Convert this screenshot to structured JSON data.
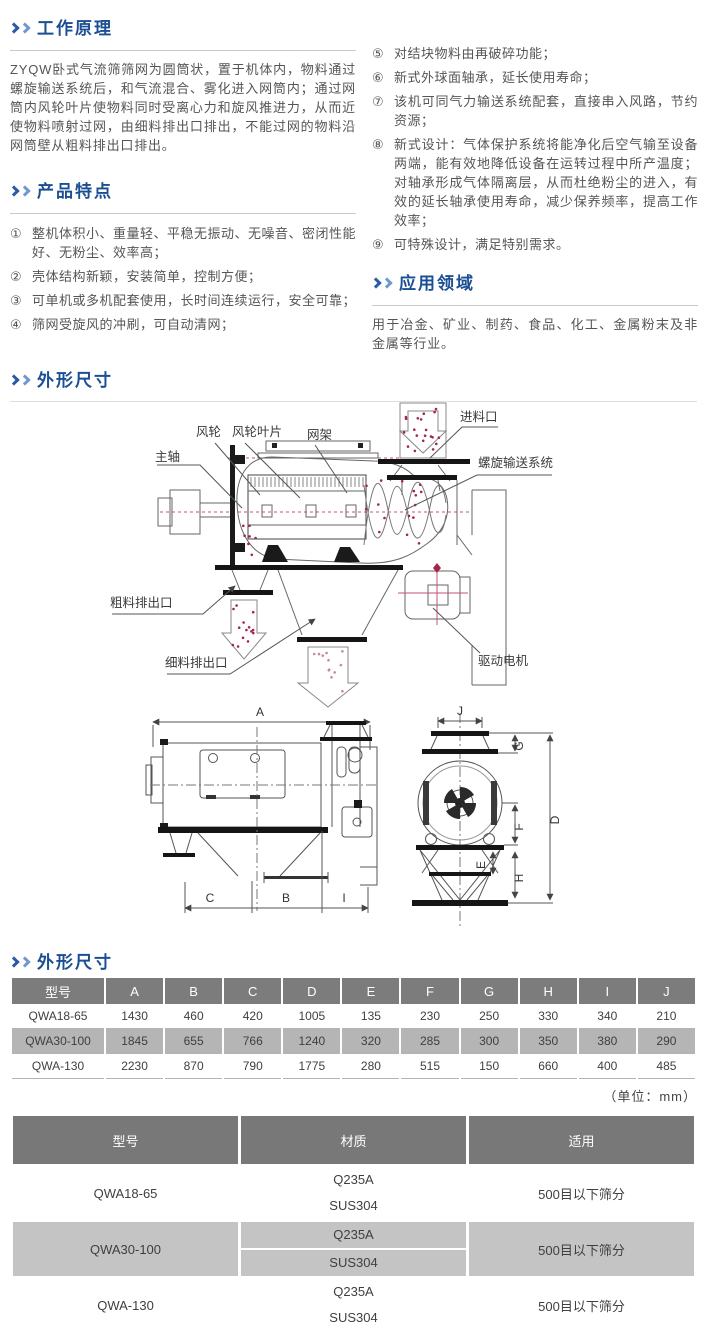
{
  "colors": {
    "accent_blue": "#1b4f93",
    "chevron_dark": "#2a5aa5",
    "chevron_light": "#7198cc",
    "table_header_bg": "#7c7c7c",
    "table_stripe": "#b5b5b5",
    "diagram_red": "#a3264a"
  },
  "working_principle": {
    "title": "工作原理",
    "body": "ZYQW卧式气流筛筛网为圆筒状，置于机体内，物料通过螺旋输送系统后，和气流混合、雾化进入网筒内；通过网筒内风轮叶片使物料同时受离心力和旋风推进力，从而近使物料喷射过网，由细料排出口排出，不能过网的物料沿网筒壁从粗料排出口排出。"
  },
  "features": {
    "title": "产品特点",
    "items": [
      {
        "num": "①",
        "text": "整机体积小、重量轻、平稳无振动、无噪音、密闭性能好、无粉尘、效率高；"
      },
      {
        "num": "②",
        "text": "壳体结构新颖，安装简单，控制方便；"
      },
      {
        "num": "③",
        "text": "可单机或多机配套使用，长时间连续运行，安全可靠；"
      },
      {
        "num": "④",
        "text": "筛网受旋风的冲刷，可自动清网；"
      },
      {
        "num": "⑤",
        "text": "对结块物料由再破碎功能；"
      },
      {
        "num": "⑥",
        "text": "新式外球面轴承，延长使用寿命；"
      },
      {
        "num": "⑦",
        "text": "该机可同气力输送系统配套，直接串入风路，节约资源；"
      },
      {
        "num": "⑧",
        "text": "新式设计：气体保护系统将能净化后空气输至设备两端，能有效地降低设备在运转过程中所产温度；对轴承形成气体隔离层，从而杜绝粉尘的进入，有效的延长轴承使用寿命，减少保养频率，提高工作效率；"
      },
      {
        "num": "⑨",
        "text": "可特殊设计，满足特别需求。"
      }
    ]
  },
  "application": {
    "title": "应用领域",
    "body": "用于冶金、矿业、制药、食品、化工、金属粉末及非金属等行业。"
  },
  "outline_section": {
    "title": "外形尺寸"
  },
  "diagram": {
    "labels": {
      "fan_wheel": "风轮",
      "fan_blade": "风轮叶片",
      "net_frame": "网架",
      "main_shaft": "主轴",
      "feed_inlet": "进料口",
      "screw_system": "螺旋输送系统",
      "coarse_outlet": "粗料排出口",
      "fine_outlet": "细料排出口",
      "drive_motor": "驱动电机"
    },
    "dims_side": {
      "A": "A",
      "C": "C",
      "B": "B",
      "I": "I"
    },
    "dims_front": {
      "J": "J",
      "G": "G",
      "F": "F",
      "E": "E",
      "H": "H",
      "D": "D"
    }
  },
  "dim_table": {
    "title": "外形尺寸",
    "unit_note": "（单位：mm）",
    "headers": [
      "型号",
      "A",
      "B",
      "C",
      "D",
      "E",
      "F",
      "G",
      "H",
      "I",
      "J"
    ],
    "rows": [
      {
        "model": "QWA18-65",
        "values": [
          "1430",
          "460",
          "420",
          "1005",
          "135",
          "230",
          "250",
          "330",
          "340",
          "210"
        ]
      },
      {
        "model": "QWA30-100",
        "values": [
          "1845",
          "655",
          "766",
          "1240",
          "320",
          "285",
          "300",
          "350",
          "380",
          "290"
        ]
      },
      {
        "model": "QWA-130",
        "values": [
          "2230",
          "870",
          "790",
          "1775",
          "280",
          "515",
          "150",
          "660",
          "400",
          "485"
        ]
      }
    ]
  },
  "material_table": {
    "headers": [
      "型号",
      "材质",
      "适用"
    ],
    "rows": [
      {
        "model": "QWA18-65",
        "material1": "Q235A",
        "material2": "SUS304",
        "application": "500目以下筛分"
      },
      {
        "model": "QWA30-100",
        "material1": "Q235A",
        "material2": "SUS304",
        "application": "500目以下筛分"
      },
      {
        "model": "QWA-130",
        "material1": "Q235A",
        "material2": "SUS304",
        "application": "500目以下筛分"
      }
    ]
  }
}
